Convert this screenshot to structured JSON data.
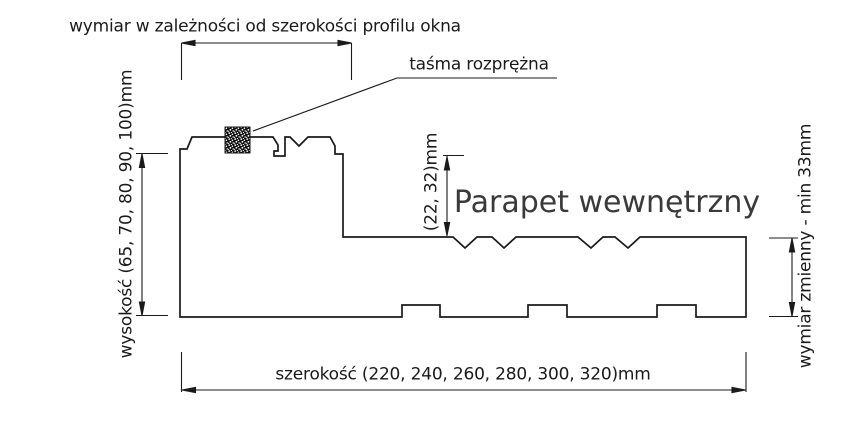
{
  "drawing": {
    "type": "technical-cross-section",
    "subject_label": "Parapet wewnętrzny",
    "labels": {
      "top_dimension": "wymiar w zależności od szerokości profilu okna",
      "tape_callout": "taśma rozprężna",
      "height_dimension": "wysokość (65, 70, 80, 90, 100)mm",
      "front_edge_dimension": "(22, 32)mm",
      "right_dimension": "wymiar zmienny - min 33mm",
      "width_dimension": "szerokość (220, 240, 260, 280, 300, 320)mm"
    },
    "colors": {
      "line": "#1a1a1a",
      "text": "#1a1a1a",
      "title_text": "#3a3a3a",
      "background": "#ffffff",
      "tape_fill": "#111111"
    }
  }
}
